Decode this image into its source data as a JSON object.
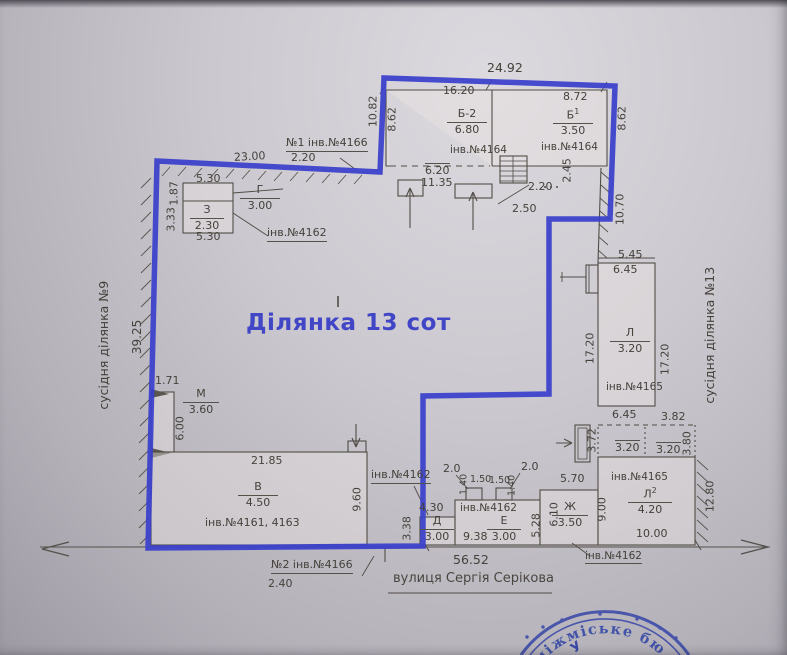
{
  "plot": {
    "title": "Ділянка 13 сот",
    "boundary_color": "#3a40cb"
  },
  "neighbors": {
    "left": "сусідня ділянка №9",
    "right": "сусідня ділянка №13"
  },
  "street": {
    "name": "вулиця Сергія Серікова",
    "frontage": "56.52"
  },
  "gates": {
    "g1": {
      "label": "№1 інв.№4166",
      "width": "2.20"
    },
    "g2": {
      "label": "№2 інв.№4166",
      "width": "2.40"
    }
  },
  "outer": {
    "left_len": "39.25",
    "top_left": "23.00",
    "top": "24.92",
    "left_out": "10.82",
    "right_up": "10.70",
    "right_low": "12.80"
  },
  "bld": {
    "b2": {
      "letter": "Б-2",
      "h": "6.80",
      "w": "16.20",
      "d": "8.62",
      "inv": "інв.№4164"
    },
    "b1": {
      "letter": "Б",
      "sup": "1",
      "h": "3.50",
      "w": "8.72",
      "d": "8.62",
      "inv": "інв.№4164"
    },
    "g": {
      "letter": "Г",
      "h": "3.00"
    },
    "z": {
      "letter": "З",
      "h": "2.30",
      "w_top": "5.30",
      "w_bot": "5.30",
      "d1": "1.87",
      "d2": "3.33",
      "inv": "інв.№4162"
    },
    "m": {
      "letter": "М",
      "h": "3.60",
      "off": "1.71",
      "d": "6.00"
    },
    "v": {
      "letter": "В",
      "h": "4.50",
      "w": "21.85",
      "d": "9.60",
      "inv": "інв.№4161, 4163",
      "inv2": "інв.№4162"
    },
    "l": {
      "letter": "Л",
      "h": "3.20",
      "top": "5.45",
      "w": "6.45",
      "dl": "17.20",
      "dr": "17.20",
      "inv": "інв.№4165"
    },
    "l2": {
      "letter": "Л",
      "sup": "2",
      "h": "4.20",
      "w": "10.00",
      "d": "9.00",
      "inv": "інв.№4165",
      "s_w1": "6.45",
      "s_w2": "3.82",
      "s_h1": "3.72",
      "s_v1": "3.20",
      "s_v2": "3.20",
      "s_h2": "3.80"
    },
    "d": {
      "letter": "Д",
      "h": "3.00",
      "w": "4.30",
      "d": "3.38"
    },
    "e": {
      "letter": "Е",
      "h": "3.00",
      "w": "9.38",
      "d": "5.28",
      "inv": "інв.№4162",
      "n1": "2.0",
      "n2": "1.40",
      "n3": "1.50",
      "n4": "1.50",
      "n5": "1.40",
      "n6": "2.0"
    },
    "zh": {
      "letter": "Ж",
      "h": "3.50",
      "w": "5.70",
      "d": "6.10",
      "inv": "інв.№4162"
    }
  },
  "porch": {
    "w1": "6.20",
    "w2": "11.35",
    "r1": "2.20",
    "r2": "2.45",
    "r3": "2.50"
  },
  "stamp": {
    "text": "міжміське бю",
    "letter": "У"
  }
}
